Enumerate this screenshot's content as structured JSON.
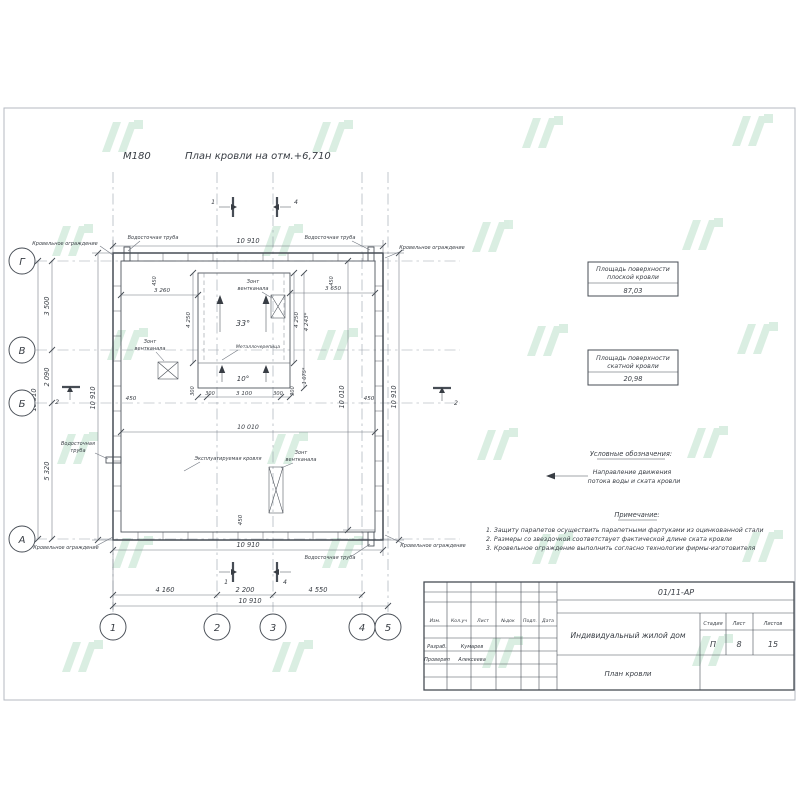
{
  "sheet": {
    "scale": "М180",
    "title": "План кровли на отм.+6,710"
  },
  "axes": {
    "c1": "1",
    "c2": "2",
    "c3": "3",
    "c4": "4",
    "c5": "5",
    "r1": "Г",
    "r2": "В",
    "r3": "Б",
    "r4": "А"
  },
  "sections": {
    "s1": "1",
    "s2": "2",
    "s4": "4"
  },
  "dims": {
    "top_total": "10 910",
    "left_total": "10 910",
    "left_seg1": "3 500",
    "left_seg2": "2 090",
    "left_seg3": "5 320",
    "left_roof": "10 910",
    "overhang": "450",
    "top_left": "3 260",
    "top_right": "3 650",
    "slope_left": "4 250",
    "slope_right": "4 250",
    "slope_actual": "4 243*",
    "strip_actual": "1 075*",
    "strip_side": "300",
    "strip_mid": "3 100",
    "inner_width": "10 010",
    "inner_height": "10 010",
    "right_total": "10 910",
    "bottom_roof": "10 910",
    "axis_12": "4 160",
    "axis_23": "2 200",
    "axis_34": "4 550",
    "axis_total": "10 910"
  },
  "plan": {
    "slope33": "33°",
    "slope10": "10°",
    "material": "Металлочерепица",
    "exploited": "Эксплуатируемая кровля",
    "vent_l1": "Зонт",
    "vent_l2": "вентканала",
    "fence": "Кровельное ограждение",
    "drain": "Водосточная труба",
    "drain_l1": "Водосточная",
    "drain_l2": "труба"
  },
  "panels": {
    "flat": {
      "l1": "Площадь поверхности",
      "l2": "плоской кровли",
      "value": "87,03"
    },
    "sloped": {
      "l1": "Площадь поверхности",
      "l2": "скатной кровли",
      "value": "20,98"
    },
    "legend": {
      "heading": "Условные обозначения:",
      "l1": "Направление движения",
      "l2": "потока воды и ската кровли"
    },
    "notes": {
      "heading": "Примечание:",
      "n1": "1. Защиту парапетов осуществить парапетными фартуками из оцинкованной стали",
      "n2": "2. Размеры со звездочкой соответствует фактической длине ската кровли",
      "n3": "3. Кровельное ограждение выполнить согласно технологии фирмы-изготовителя"
    }
  },
  "titleblock": {
    "doc": "01/11-АР",
    "cols": {
      "c1": "Изм.",
      "c2": "Кол.уч",
      "c3": "Лист",
      "c4": "№док",
      "c5": "Подп.",
      "c6": "Дата"
    },
    "rows": {
      "r1": "Разраб.",
      "r1v": "Кумарев",
      "r2": "Проверил",
      "r2v": "Алексеева"
    },
    "project": "Индивидуальный жилой дом",
    "sheet_name": "План кровли",
    "stage": {
      "h1": "Стадия",
      "h2": "Лист",
      "h3": "Листов",
      "v1": "П",
      "v2": "8",
      "v3": "15"
    }
  }
}
